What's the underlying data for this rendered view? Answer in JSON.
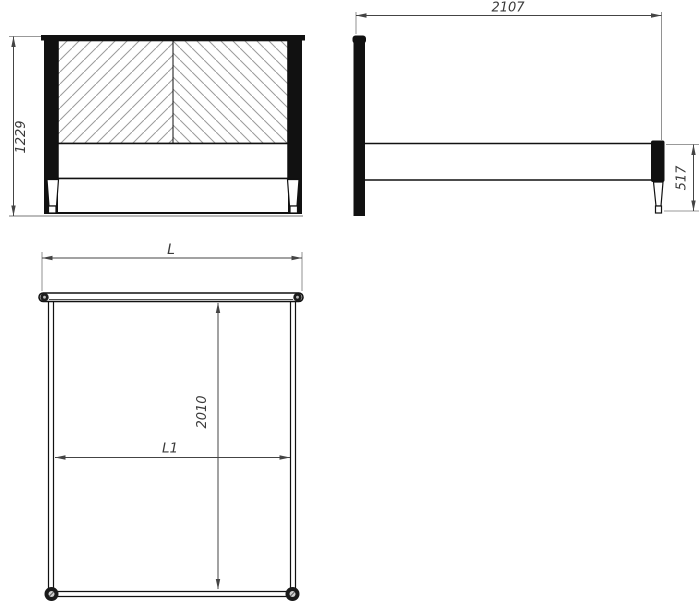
{
  "drawing": {
    "views": {
      "front": {
        "overall_height": "1229"
      },
      "side": {
        "overall_length": "2107",
        "footboard_height": "517"
      },
      "plan": {
        "overall_width_label": "L",
        "inner_width_label": "L1",
        "inner_length": "2010"
      }
    },
    "colors": {
      "background": "#ffffff",
      "outline": "#111111",
      "hatch": "#9b9b9b",
      "dimension_line": "#444444",
      "extension_line": "#777777",
      "text": "#3a3a3a"
    }
  }
}
